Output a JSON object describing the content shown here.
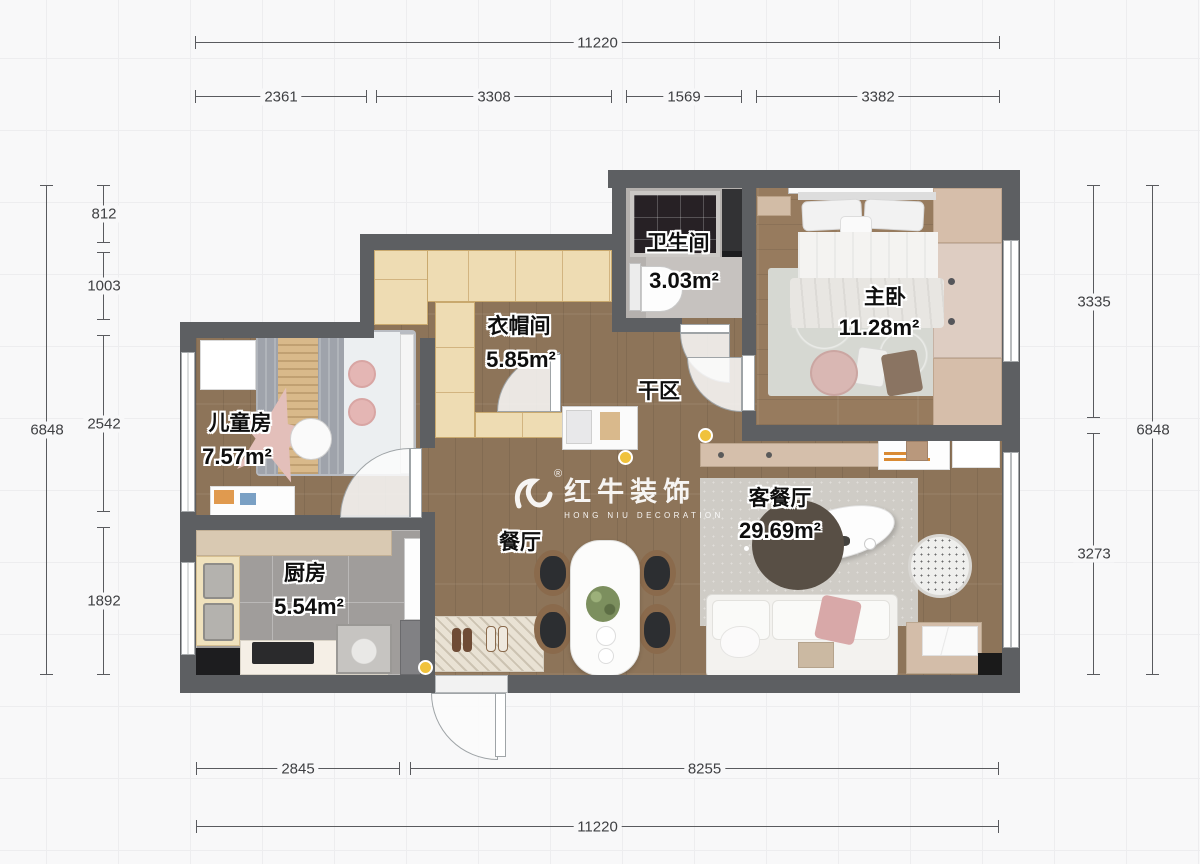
{
  "watermark": {
    "reg": "®",
    "brand": "红牛装饰",
    "sub": "HONG NIU DECORATION"
  },
  "rooms": [
    {
      "id": "bathroom",
      "name": "卫生间",
      "area": "3.03m²"
    },
    {
      "id": "master-bedroom",
      "name": "主卧",
      "area": "11.28m²"
    },
    {
      "id": "cloakroom",
      "name": "衣帽间",
      "area": "5.85m²"
    },
    {
      "id": "dry-area",
      "name": "干区",
      "area": ""
    },
    {
      "id": "kids-room",
      "name": "儿童房",
      "area": "7.57m²"
    },
    {
      "id": "kitchen",
      "name": "厨房",
      "area": "5.54m²"
    },
    {
      "id": "dining",
      "name": "餐厅",
      "area": ""
    },
    {
      "id": "living-dining",
      "name": "客餐厅",
      "area": "29.69m²"
    }
  ],
  "dimensions": {
    "top_total": "11220",
    "top_segments": [
      "2361",
      "3308",
      "1569",
      "3382"
    ],
    "left_total": "6848",
    "left_segments": [
      "812",
      "1003",
      "2542",
      "1892"
    ],
    "right_total": "6848",
    "right_segments": [
      "3335",
      "3273"
    ],
    "bottom_total": "11220",
    "bottom_segments": [
      "2845",
      "8255"
    ]
  },
  "colors": {
    "wall": "#5d5f62",
    "wood_floor": "#8d7459",
    "tile_floor": "#a09d9b",
    "cabinet": "#eedcb3",
    "accent_yellow": "#f0c23c",
    "dim_line": "#595a5e"
  }
}
